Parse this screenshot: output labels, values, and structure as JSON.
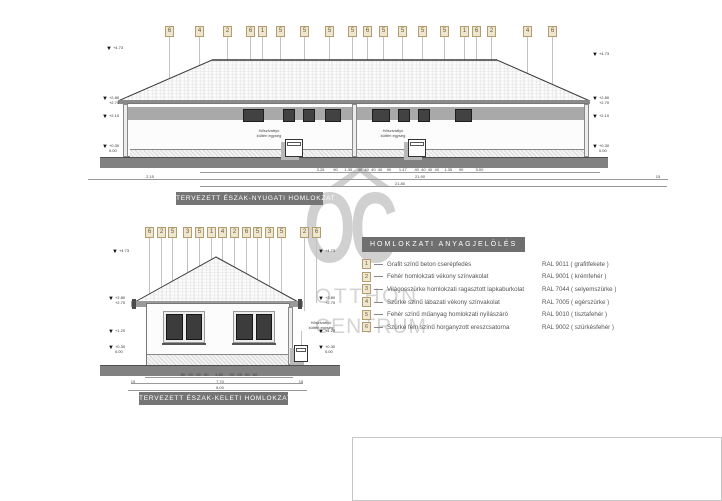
{
  "watermark": {
    "line1": "OC",
    "line2": "OTTHON",
    "line3": "CENTRUM"
  },
  "labels": {
    "heat_pump_line1": "Hőszivattyú",
    "heat_pump_line2": "kültéri egység"
  },
  "legend": {
    "title": "HOMLOKZATI ANYAGJELÖLÉS",
    "items": [
      {
        "num": "1",
        "desc": "Grafit színű beton cserépfedés",
        "ral": "RAL 9011 ( grafitfekete )"
      },
      {
        "num": "2",
        "desc": "Fehér homlokzati vékony színvakolat",
        "ral": "RAL 9001 ( krémfehér )"
      },
      {
        "num": "3",
        "desc": "Világosszürke homlokzati ragasztott lapkaburkolat",
        "ral": "RAL 7044 ( selyemszürke )"
      },
      {
        "num": "4",
        "desc": "Szürke színű lábazati vékony színvakolat",
        "ral": "RAL 7005 ( egérszürke )"
      },
      {
        "num": "5",
        "desc": "Fehér színű műanyag homlokzati nyílászáró",
        "ral": "RAL 9010 ( tisztafehér )"
      },
      {
        "num": "6",
        "desc": "Szürke fém színű horganyzott ereszcsatorna",
        "ral": "RAL 9002 ( szürkésfehér )"
      }
    ]
  },
  "elevation_nw": {
    "title": "TERVEZETT ÉSZAK-NYUGATI HOMLOKZAT",
    "markers": [
      "6",
      "4",
      "2",
      "6",
      "1",
      "5",
      "5",
      "5",
      "5",
      "6",
      "5",
      "5",
      "5",
      "5",
      "1",
      "6",
      "2",
      "4",
      "6"
    ],
    "levels": {
      "ridge": "+4.73",
      "eave_top": "+2.80",
      "eave_bottom": "+2.70",
      "mid": "+2.10",
      "base_top": "+0.30",
      "base_bottom": "0.00"
    },
    "dims": {
      "segments": "3.25        90      1.35     40  40  40  40    90       1.47       40  40  40  40     1.35      90           5.00",
      "left": "2.15",
      "total1": "21.90",
      "right": "15",
      "total2": "21.80"
    }
  },
  "elevation_ne": {
    "title": "TERVEZETT ÉSZAK-KELETI HOMLOKZAT",
    "markers": [
      "6",
      "2",
      "5",
      "3",
      "5",
      "1",
      "4",
      "2",
      "6",
      "5",
      "3",
      "5",
      "2",
      "6"
    ],
    "levels": {
      "ridge": "+4.73",
      "eave_top": "+2.80",
      "eave_bottom": "+2.70",
      "mid": "+1.20",
      "base_top": "+0.30",
      "base_bottom": "0.00"
    },
    "dims": {
      "segments": "80   90   25   90      1.80      90   25   90   80",
      "left": "15",
      "total1": "7.70",
      "right": "15",
      "total2": "8.00"
    }
  }
}
